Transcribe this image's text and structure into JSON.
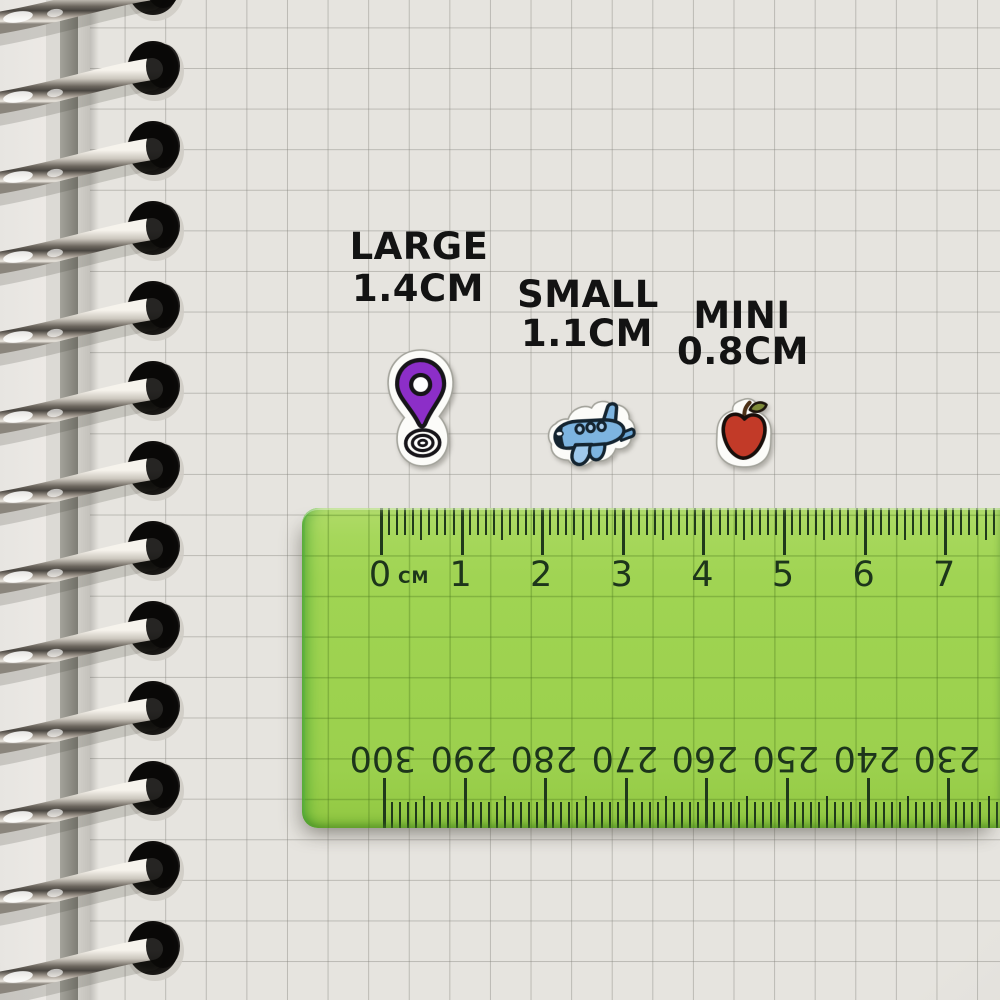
{
  "size_labels": [
    {
      "name": "LARGE",
      "size": "1.4CM"
    },
    {
      "name": "SMALL",
      "size": "1.1CM"
    },
    {
      "name": "MINI",
      "size": "0.8CM"
    }
  ],
  "stickers": [
    {
      "name": "location-pin",
      "color": "#8c2ec8"
    },
    {
      "name": "airplane",
      "color": "#7db4e0"
    },
    {
      "name": "apple",
      "color": "#c23a28"
    }
  ],
  "ruler": {
    "unit_label": "CM",
    "cm_numbers": [
      "0",
      "1",
      "2",
      "3",
      "4",
      "5",
      "6",
      "7"
    ],
    "mm_numbers_upside_down": [
      "300",
      "290",
      "280",
      "270",
      "260",
      "250",
      "240",
      "230"
    ],
    "body_color": "#9dd24f",
    "marking_color": "#20391b"
  }
}
